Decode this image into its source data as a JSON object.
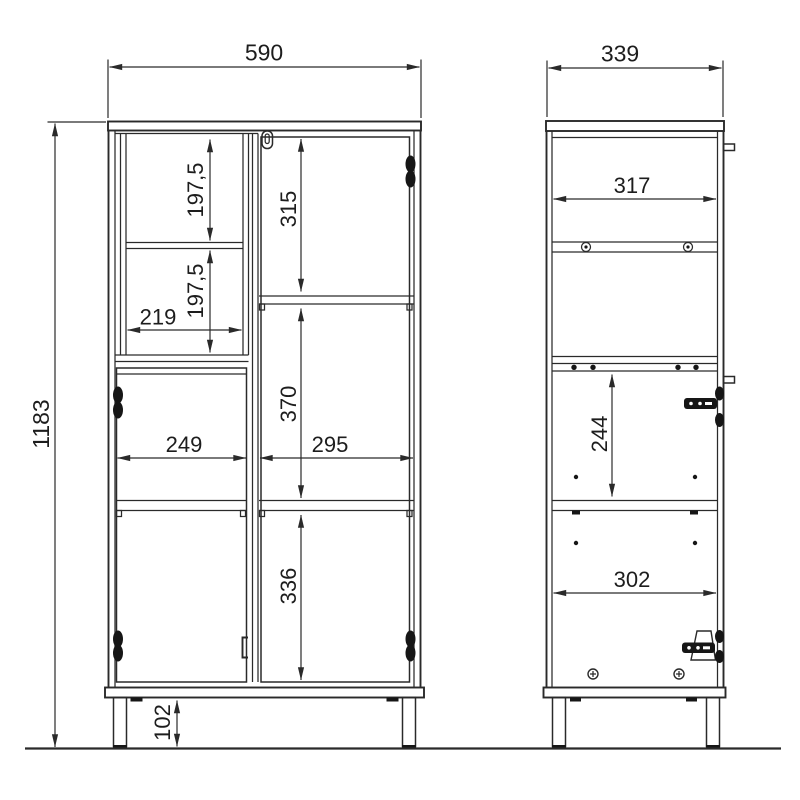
{
  "drawing": {
    "kind": "furniture cabinet technical drawing, front and side elevation with dimensions",
    "colors": {
      "background": "#ffffff",
      "line": "#2a2a2a",
      "text": "#1d1d1d"
    },
    "icons": {
      "hinge": "door-hinge",
      "lock": "cam-lock",
      "handle": "door-handle",
      "knob": "wall-mount-knob",
      "screw": "screw-head",
      "shelf_pin": "shelf-pin"
    }
  },
  "dimensions": {
    "front": {
      "overall_width": "590",
      "overall_height": "1183",
      "open_shelf_upper_height": "197,5",
      "open_shelf_lower_height": "197,5",
      "open_shelf_width": "219",
      "upper_right_height": "315",
      "middle_right_height": "370",
      "lower_left_width": "249",
      "lower_right_width": "295",
      "lower_right_height": "336",
      "leg_height": "102"
    },
    "side": {
      "overall_depth": "339",
      "upper_inner_depth": "317",
      "hinge_spacing": "244",
      "lower_inner_depth": "302"
    }
  }
}
